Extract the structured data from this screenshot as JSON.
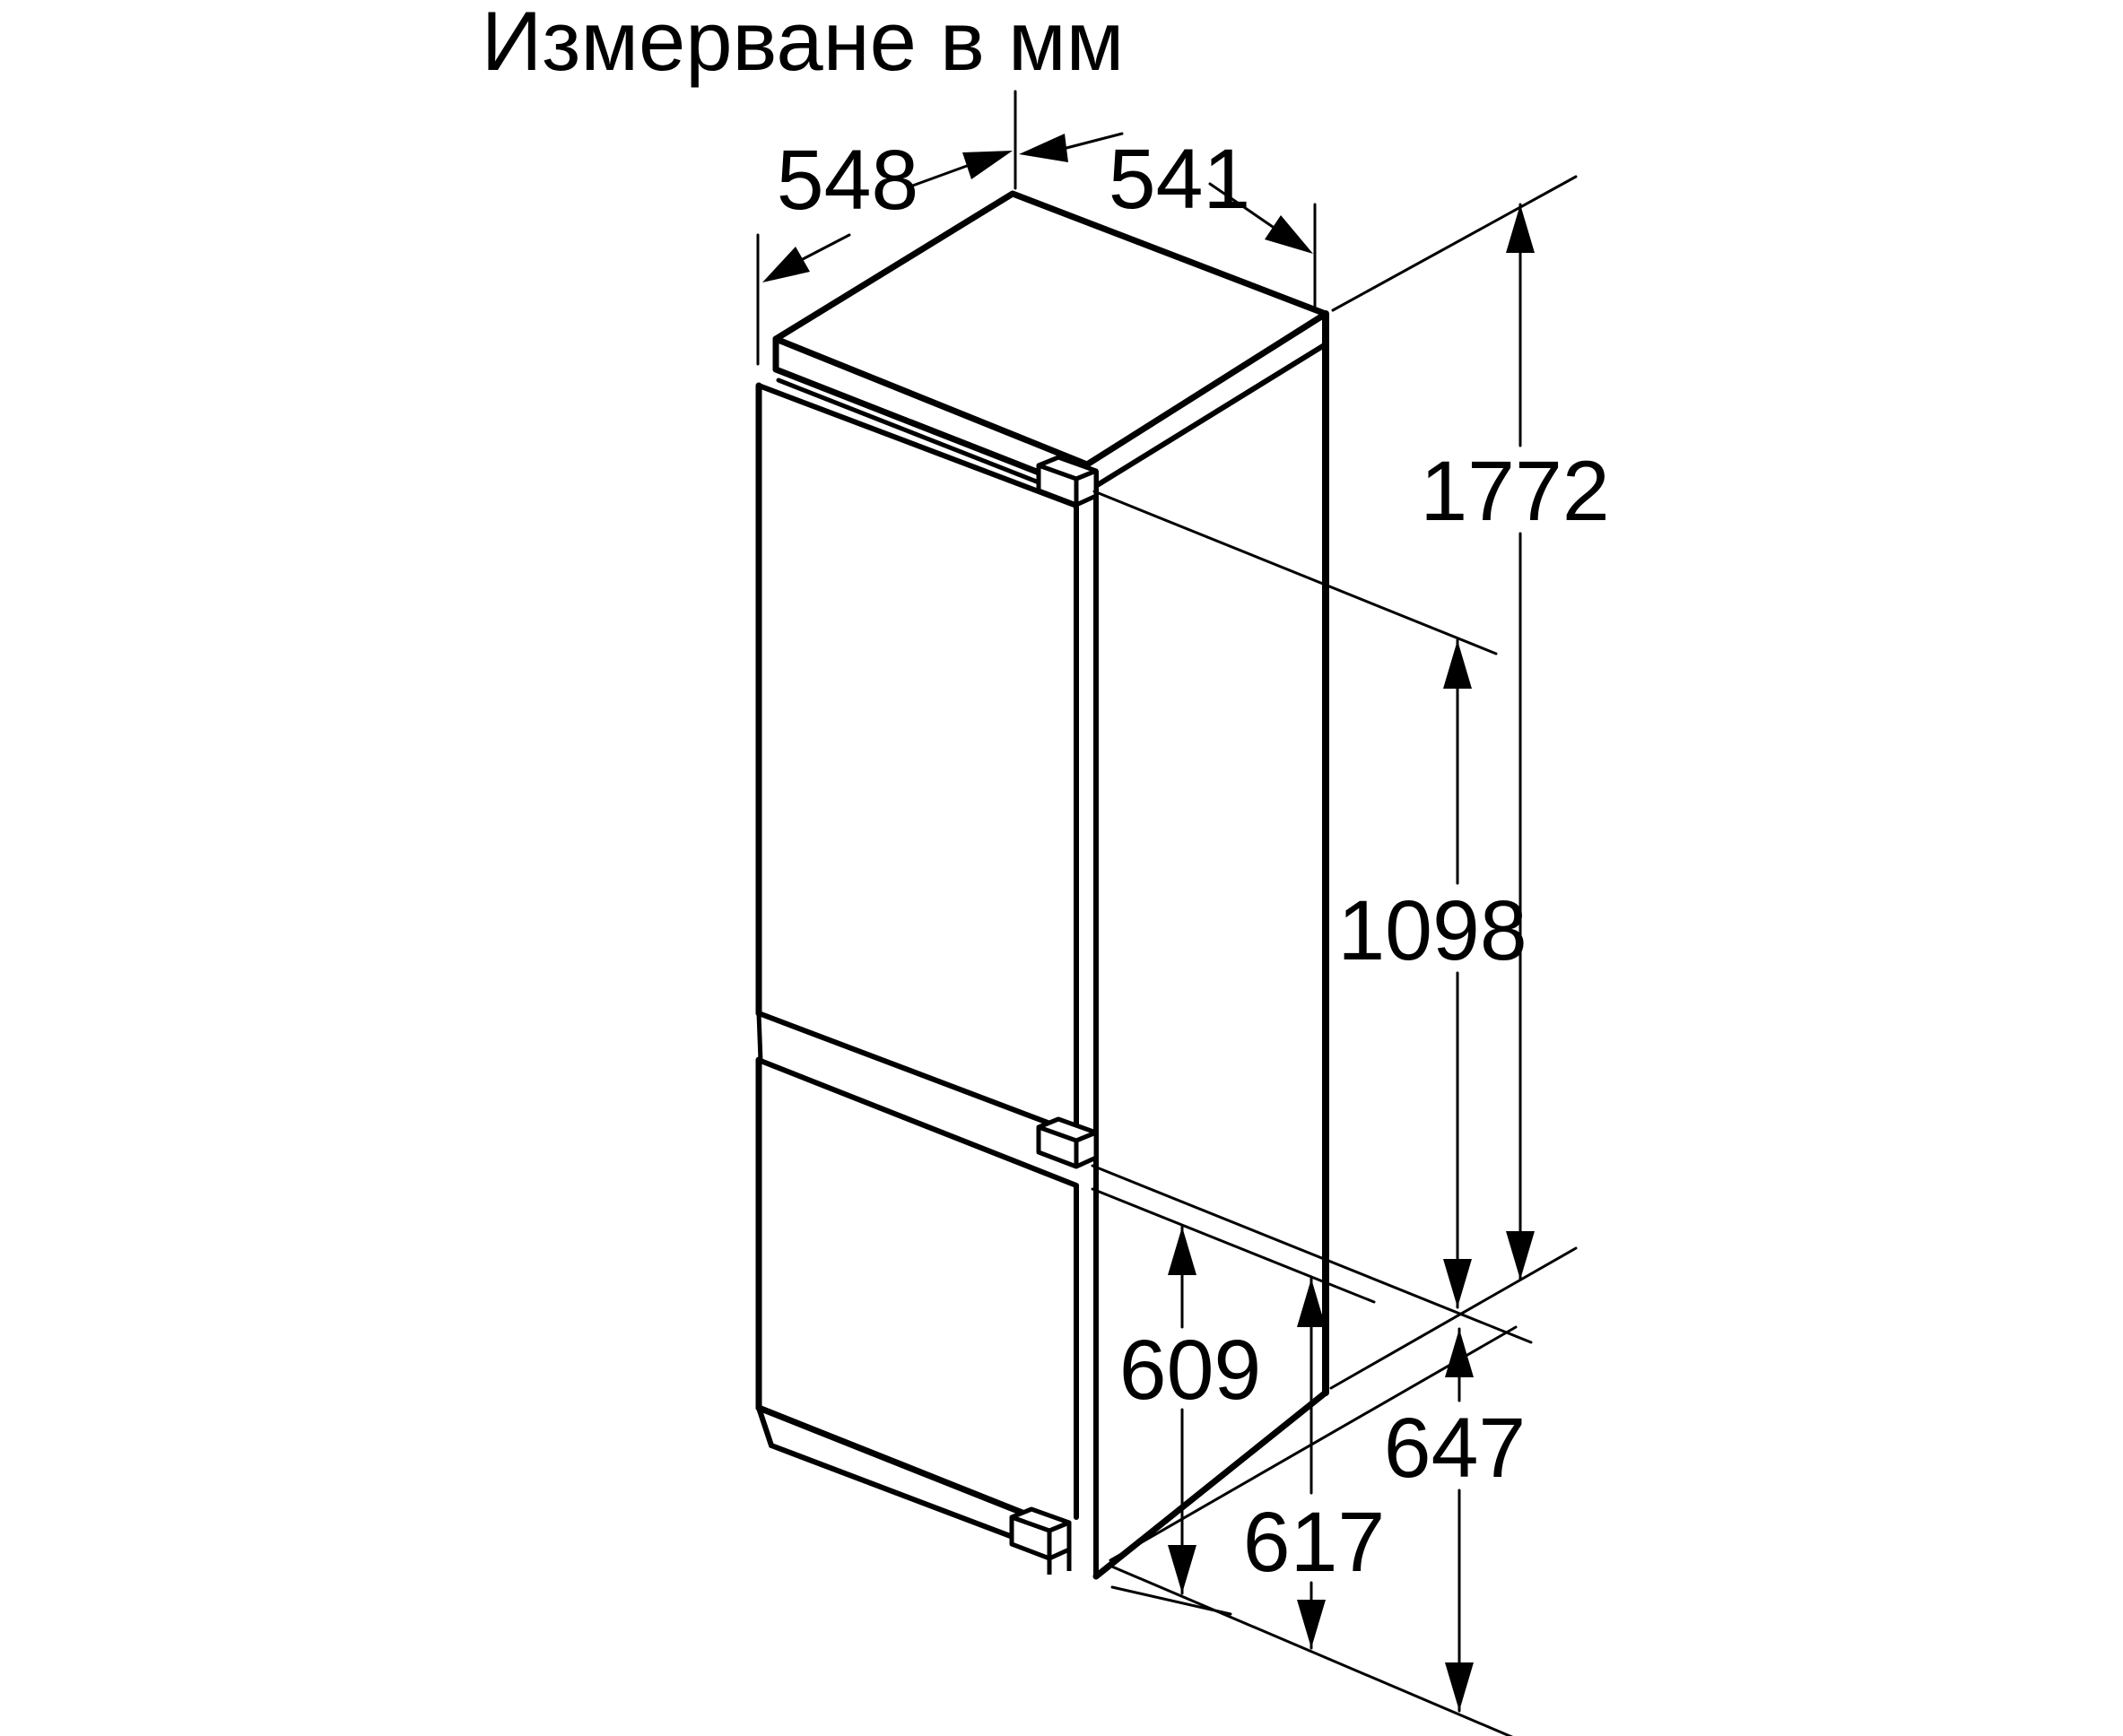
{
  "title": "Измерване в мм",
  "dims": {
    "d548": "548",
    "d541": "541",
    "d1772": "1772",
    "d1098": "1098",
    "d609": "609",
    "d647": "647",
    "d617": "617"
  },
  "colors": {
    "line": "#000000",
    "background": "#ffffff"
  }
}
